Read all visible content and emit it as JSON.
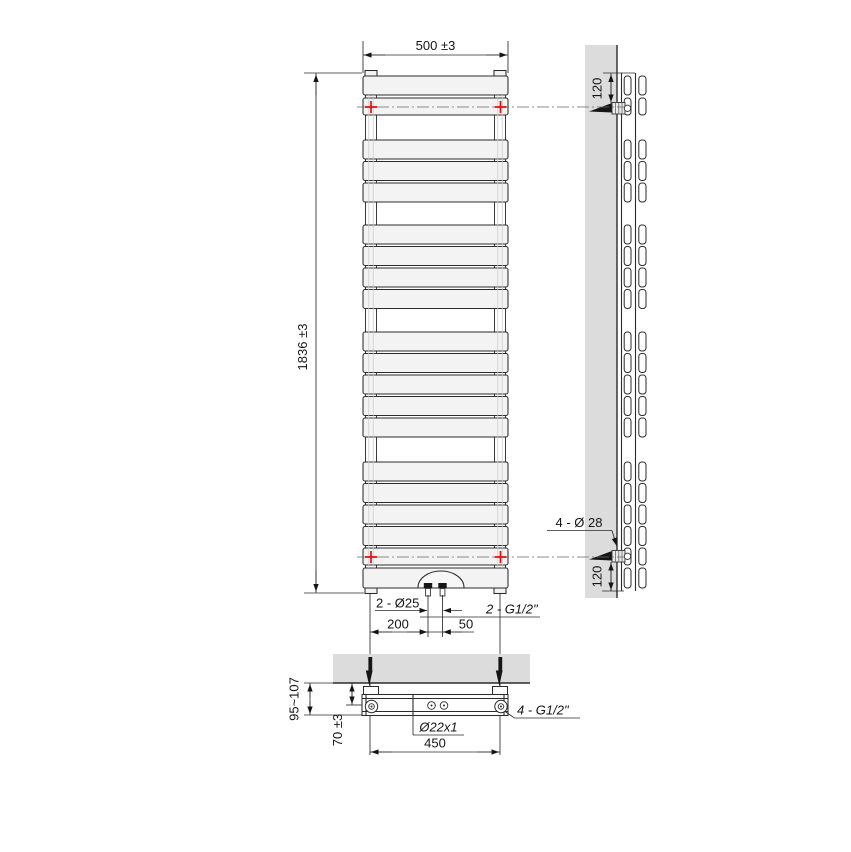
{
  "drawing": {
    "front": {
      "width_dim": "500 ±3",
      "height_dim": "1836 ±3",
      "conn_count_dia": "2 - Ø25",
      "conn_thread": "2 - G1/2\"",
      "conn_offset": "200",
      "conn_spacing": "50"
    },
    "side": {
      "top_bracket_offset": "120",
      "bottom_bracket_offset": "120",
      "riser_spec": "4 - Ø 28"
    },
    "plan": {
      "wall_clearance": "95~107",
      "axis_clearance": "70 ±3",
      "tube_spec": "Ø22x1",
      "bracket_spacing": "450",
      "thread_spec": "4 - G1/2\""
    },
    "colors": {
      "line": "#2b2b2b",
      "panel_fill": "#f3f3f3",
      "wall_fill": "#dcdcdc",
      "marker_red": "#e01010"
    }
  }
}
